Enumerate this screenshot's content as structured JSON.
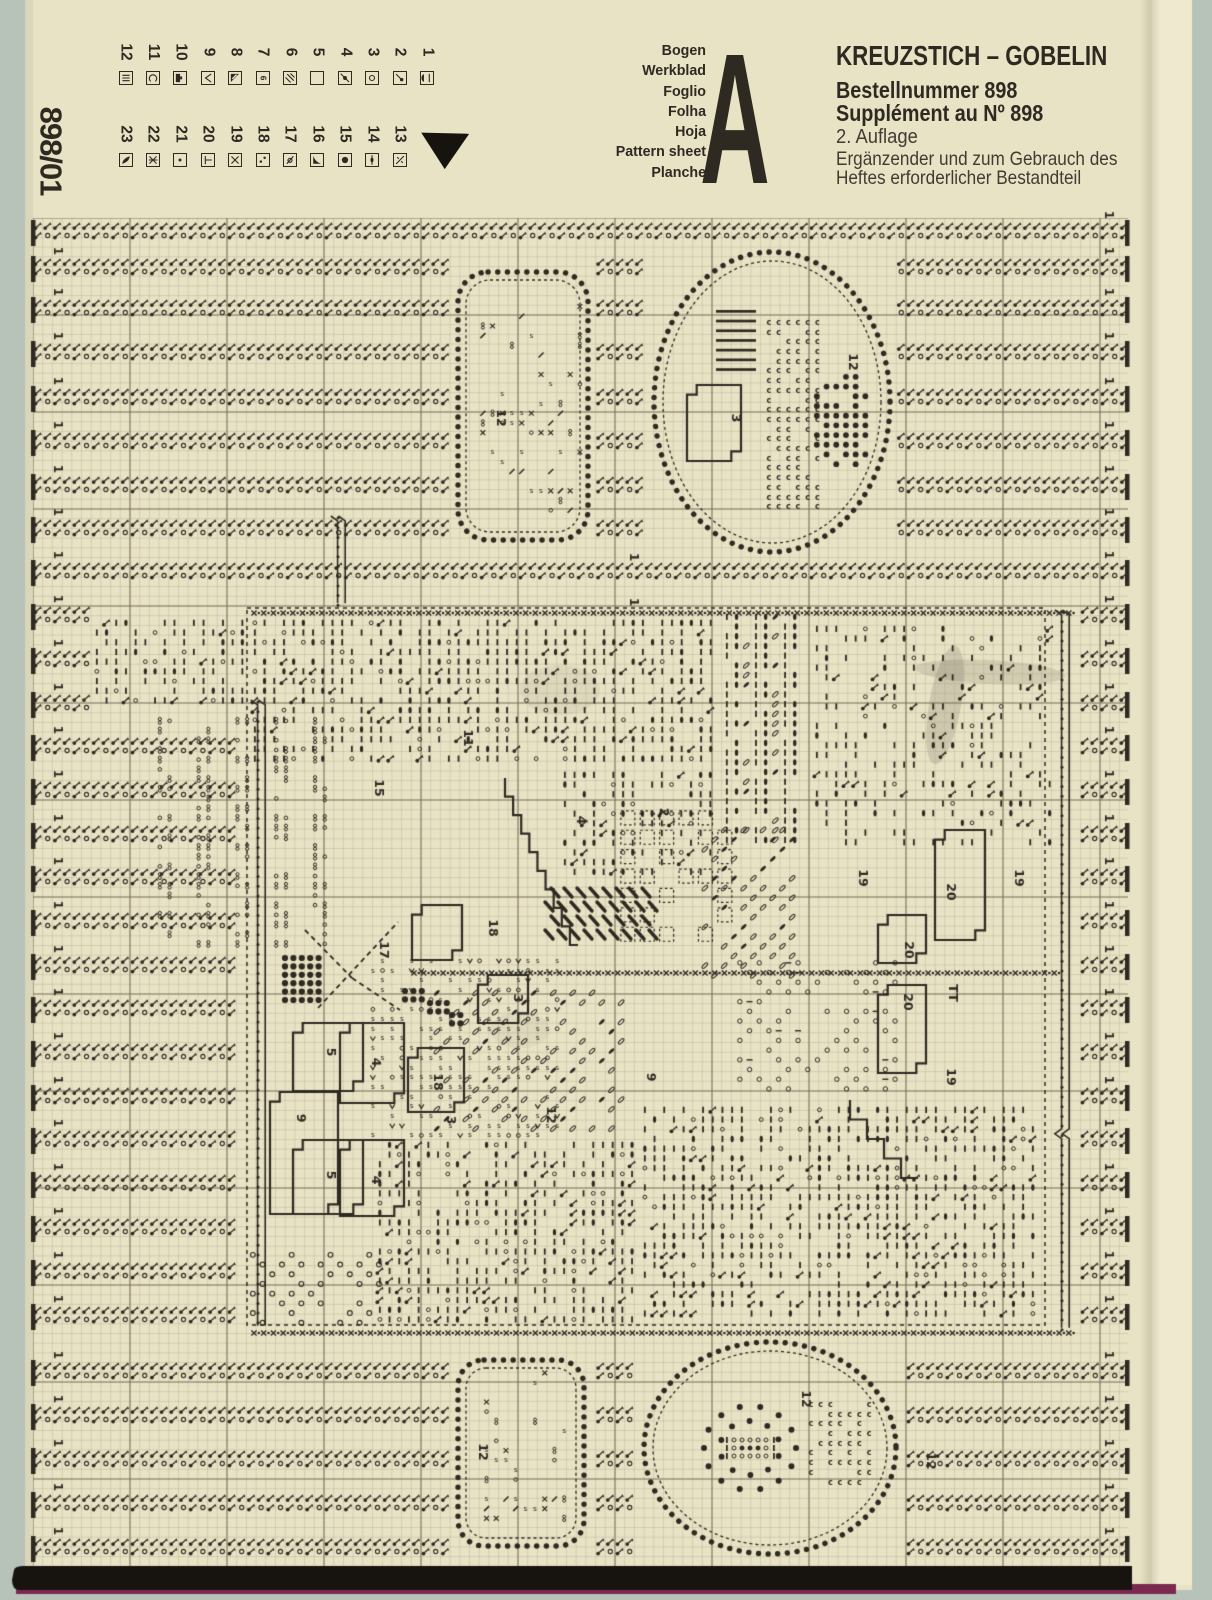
{
  "sheet_id": "898/01",
  "header": {
    "languages": [
      "Bogen",
      "Werkblad",
      "Foglio",
      "Folha",
      "Hoja",
      "Pattern sheet",
      "Planche"
    ],
    "sheet_letter": "A",
    "title": "KREUZSTICH – GOBELIN",
    "order_number": "Bestellnummer 898",
    "supplement": "Supplément au Nº 898",
    "edition": "2. Auflage",
    "note_line1": "Ergänzender und zum Gebrauch des",
    "note_line2": "Heftes erforderlicher Bestandteil"
  },
  "legend": {
    "entries": [
      {
        "num": "1",
        "symbol": "half-lens"
      },
      {
        "num": "2",
        "symbol": "comma-dot"
      },
      {
        "num": "3",
        "symbol": "circle"
      },
      {
        "num": "4",
        "symbol": "dot-slash"
      },
      {
        "num": "5",
        "symbol": "empty"
      },
      {
        "num": "6",
        "symbol": "hatch"
      },
      {
        "num": "7",
        "symbol": "six-flag"
      },
      {
        "num": "8",
        "symbol": "corner-triangle"
      },
      {
        "num": "9",
        "symbol": "check"
      },
      {
        "num": "10",
        "symbol": "half-square"
      },
      {
        "num": "11",
        "symbol": "c"
      },
      {
        "num": "12",
        "symbol": "triple-bar"
      },
      {
        "num": "13",
        "symbol": "zero-slash"
      },
      {
        "num": "14",
        "symbol": "bar-lens"
      },
      {
        "num": "15",
        "symbol": "filled-circle"
      },
      {
        "num": "16",
        "symbol": "black-triangle"
      },
      {
        "num": "17",
        "symbol": "o-slash"
      },
      {
        "num": "18",
        "symbol": "two-dots"
      },
      {
        "num": "19",
        "symbol": "x"
      },
      {
        "num": "20",
        "symbol": "t-bar"
      },
      {
        "num": "21",
        "symbol": "small-dot"
      },
      {
        "num": "22",
        "symbol": "x-bar"
      },
      {
        "num": "23",
        "symbol": "leaf-filled"
      }
    ],
    "marker_icon": "triangle-down"
  },
  "colors": {
    "paper": "#e9e3c6",
    "paper_light": "#efe9d0",
    "bg": "#b7c2b8",
    "ink": "#2e2a22",
    "grid_minor": "#a99f83",
    "grid_major": "#6f6550",
    "band_black": "#17130f",
    "fringe": "#7c2950"
  },
  "pattern": {
    "grid": {
      "x0": 33,
      "y0": 218,
      "x1": 1128,
      "y1": 1568,
      "cell": 9.7,
      "major_every": 10
    },
    "side_label": "1",
    "bands": [
      {
        "ys": [
          222,
          258,
          299,
          343,
          388,
          432,
          476,
          519,
          562
        ],
        "x1": 33,
        "x2": 1126
      },
      {
        "ys": [
          606,
          650,
          694
        ],
        "x1": 33,
        "x2": 94
      },
      {
        "ys": [
          737,
          781,
          825,
          868,
          912
        ],
        "x1": 33,
        "x2": 235
      },
      {
        "ys": [
          956,
          999,
          1043,
          1087,
          1130,
          1174,
          1218,
          1262,
          1306
        ],
        "x1": 33,
        "x2": 238
      },
      {
        "ys": [
          606,
          650,
          694,
          737,
          781,
          825,
          868,
          912,
          956,
          999,
          1043,
          1087,
          1130,
          1174,
          1218,
          1262,
          1306
        ],
        "x1": 1080,
        "x2": 1126
      },
      {
        "ys": [
          1362,
          1406,
          1450,
          1494,
          1538
        ],
        "x1": 33,
        "x2": 1126
      }
    ],
    "motifs": {
      "top_rect": {
        "x": 458,
        "y": 272,
        "w": 130,
        "h": 268,
        "r": 30
      },
      "top_oval": {
        "cx": 772,
        "cy": 402,
        "rx": 118,
        "ry": 150
      },
      "bottom_rect": {
        "x": 458,
        "y": 1360,
        "w": 126,
        "h": 186,
        "r": 26
      },
      "bottom_oval": {
        "cx": 770,
        "cy": 1448,
        "rx": 126,
        "ry": 106
      }
    },
    "field": {
      "x": 247,
      "y": 608,
      "w": 798,
      "h": 717
    },
    "dense_rows": [
      {
        "x1": 250,
        "y": 608,
        "x2": 1075
      },
      {
        "x1": 410,
        "y": 968,
        "x2": 1058
      },
      {
        "x1": 250,
        "y": 1328,
        "x2": 1075
      }
    ],
    "chains": [
      {
        "x": 1062,
        "y1": 610,
        "y2": 1330
      },
      {
        "x": 258,
        "y1": 700,
        "y2": 1330
      },
      {
        "x": 338,
        "y1": 516,
        "y2": 606
      }
    ],
    "textures": [
      {
        "type": "bars",
        "x": 92,
        "y": 618,
        "w": 158,
        "h": 96,
        "d": 1.0
      },
      {
        "type": "bars",
        "x": 250,
        "y": 618,
        "w": 472,
        "h": 152,
        "d": 1.0
      },
      {
        "type": "bars",
        "x": 560,
        "y": 770,
        "w": 162,
        "h": 115,
        "d": 0.85
      },
      {
        "type": "bars",
        "x": 812,
        "y": 624,
        "w": 246,
        "h": 230,
        "d": 0.55
      },
      {
        "type": "sparse8",
        "x": 155,
        "y": 716,
        "w": 180,
        "h": 238
      },
      {
        "type": "lenscol",
        "x": 722,
        "y": 612,
        "w": 86,
        "h": 240
      },
      {
        "type": "leafdiag",
        "x": 700,
        "y": 825,
        "w": 105,
        "h": 160
      },
      {
        "type": "dashsq",
        "x": 618,
        "y": 808,
        "w": 112,
        "h": 140
      },
      {
        "type": "hatch",
        "x": 545,
        "y": 884,
        "w": 118,
        "h": 48
      },
      {
        "type": "stext",
        "x": 368,
        "y": 956,
        "w": 195,
        "h": 188
      },
      {
        "type": "leafdiag",
        "x": 432,
        "y": 988,
        "w": 195,
        "h": 150
      },
      {
        "type": "olat",
        "x": 735,
        "y": 958,
        "w": 172,
        "h": 145
      },
      {
        "type": "bars",
        "x": 375,
        "y": 1140,
        "w": 265,
        "h": 188,
        "d": 0.9
      },
      {
        "type": "bars",
        "x": 640,
        "y": 1105,
        "w": 398,
        "h": 222,
        "d": 0.9
      },
      {
        "type": "orings",
        "x": 248,
        "y": 1250,
        "w": 145,
        "h": 78
      },
      {
        "type": "sparsexs",
        "x": 478,
        "y": 292,
        "w": 108,
        "h": 228
      },
      {
        "type": "sparsexs",
        "x": 472,
        "y": 1368,
        "w": 102,
        "h": 162
      },
      {
        "type": "ccluster",
        "x": 764,
        "y": 318,
        "w": 64,
        "h": 200
      },
      {
        "type": "ladder",
        "x": 716,
        "y": 310,
        "w": 40,
        "h": 72
      },
      {
        "type": "grapes",
        "x": 812,
        "y": 372,
        "w": 62,
        "h": 102
      },
      {
        "type": "ccluster",
        "x": 806,
        "y": 1400,
        "w": 70,
        "h": 92
      },
      {
        "type": "flower",
        "x": 700,
        "y": 1392,
        "w": 100,
        "h": 112
      }
    ],
    "outlines": [
      {
        "x": 687,
        "y": 385,
        "w": 54,
        "h": 76
      },
      {
        "x": 412,
        "y": 905,
        "w": 50,
        "h": 55
      },
      {
        "x": 478,
        "y": 975,
        "w": 50,
        "h": 48
      },
      {
        "x": 408,
        "y": 1048,
        "w": 56,
        "h": 64
      },
      {
        "x": 293,
        "y": 1023,
        "w": 70,
        "h": 68
      },
      {
        "x": 340,
        "y": 1023,
        "w": 64,
        "h": 80
      },
      {
        "x": 270,
        "y": 1092,
        "w": 68,
        "h": 122
      },
      {
        "x": 293,
        "y": 1140,
        "w": 70,
        "h": 74
      },
      {
        "x": 340,
        "y": 1140,
        "w": 64,
        "h": 76
      },
      {
        "x": 935,
        "y": 830,
        "w": 50,
        "h": 110
      },
      {
        "x": 878,
        "y": 915,
        "w": 48,
        "h": 48
      },
      {
        "x": 878,
        "y": 985,
        "w": 48,
        "h": 88
      }
    ],
    "stairlines": [
      {
        "x1": 505,
        "y1": 778,
        "x2": 578,
        "y2": 945
      },
      {
        "x1": 850,
        "y1": 1100,
        "x2": 918,
        "y2": 1178
      }
    ],
    "dashed_lines": [
      {
        "x1": 318,
        "y1": 1008,
        "x2": 398,
        "y2": 922
      },
      {
        "x1": 305,
        "y1": 930,
        "x2": 352,
        "y2": 978
      },
      {
        "x1": 352,
        "y1": 978,
        "x2": 400,
        "y2": 1010
      }
    ],
    "dot_clusters": [
      {
        "x": 285,
        "y": 958,
        "cols": 5,
        "rows": 6
      },
      {
        "x": 405,
        "y": 991,
        "cols": 3,
        "rows": 2
      },
      {
        "x": 430,
        "y": 1003,
        "cols": 3,
        "rows": 2
      },
      {
        "x": 452,
        "y": 1015,
        "cols": 2,
        "rows": 2
      }
    ],
    "labels": [
      {
        "t": "12",
        "x": 500,
        "y": 418
      },
      {
        "t": "12",
        "x": 852,
        "y": 362
      },
      {
        "t": "3",
        "x": 735,
        "y": 418
      },
      {
        "t": "15",
        "x": 378,
        "y": 788
      },
      {
        "t": "11",
        "x": 467,
        "y": 738
      },
      {
        "t": "4",
        "x": 580,
        "y": 820
      },
      {
        "t": "2",
        "x": 663,
        "y": 812
      },
      {
        "t": "17",
        "x": 383,
        "y": 950
      },
      {
        "t": "18",
        "x": 492,
        "y": 928
      },
      {
        "t": "3",
        "x": 517,
        "y": 998
      },
      {
        "t": "18",
        "x": 437,
        "y": 1082
      },
      {
        "t": "3",
        "x": 450,
        "y": 1120
      },
      {
        "t": "5",
        "x": 330,
        "y": 1052
      },
      {
        "t": "4",
        "x": 375,
        "y": 1062
      },
      {
        "t": "9",
        "x": 300,
        "y": 1118
      },
      {
        "t": "5",
        "x": 330,
        "y": 1175
      },
      {
        "t": "4",
        "x": 375,
        "y": 1180
      },
      {
        "t": "12",
        "x": 550,
        "y": 1115
      },
      {
        "t": "9",
        "x": 650,
        "y": 1077
      },
      {
        "t": "19",
        "x": 862,
        "y": 878
      },
      {
        "t": "20",
        "x": 950,
        "y": 892
      },
      {
        "t": "19",
        "x": 1018,
        "y": 878
      },
      {
        "t": "20",
        "x": 908,
        "y": 950
      },
      {
        "t": "TT",
        "x": 952,
        "y": 993
      },
      {
        "t": "20",
        "x": 907,
        "y": 1002
      },
      {
        "t": "19",
        "x": 950,
        "y": 1077
      },
      {
        "t": "12",
        "x": 482,
        "y": 1452
      },
      {
        "t": "12",
        "x": 805,
        "y": 1399
      },
      {
        "t": "12",
        "x": 930,
        "y": 1461
      },
      {
        "t": "1",
        "x": 633,
        "y": 557
      },
      {
        "t": "1",
        "x": 633,
        "y": 602
      }
    ],
    "stains": [
      {
        "x": 945,
        "y": 705,
        "rx": 16,
        "ry": 60,
        "rot": 10,
        "a": 0.16
      },
      {
        "x": 990,
        "y": 672,
        "rx": 75,
        "ry": 12,
        "rot": 3,
        "a": 0.14
      },
      {
        "x": 560,
        "y": 690,
        "rx": 40,
        "ry": 25,
        "rot": 0,
        "a": 0.07
      },
      {
        "x": 520,
        "y": 1030,
        "rx": 30,
        "ry": 18,
        "rot": 0,
        "a": 0.06
      }
    ]
  }
}
